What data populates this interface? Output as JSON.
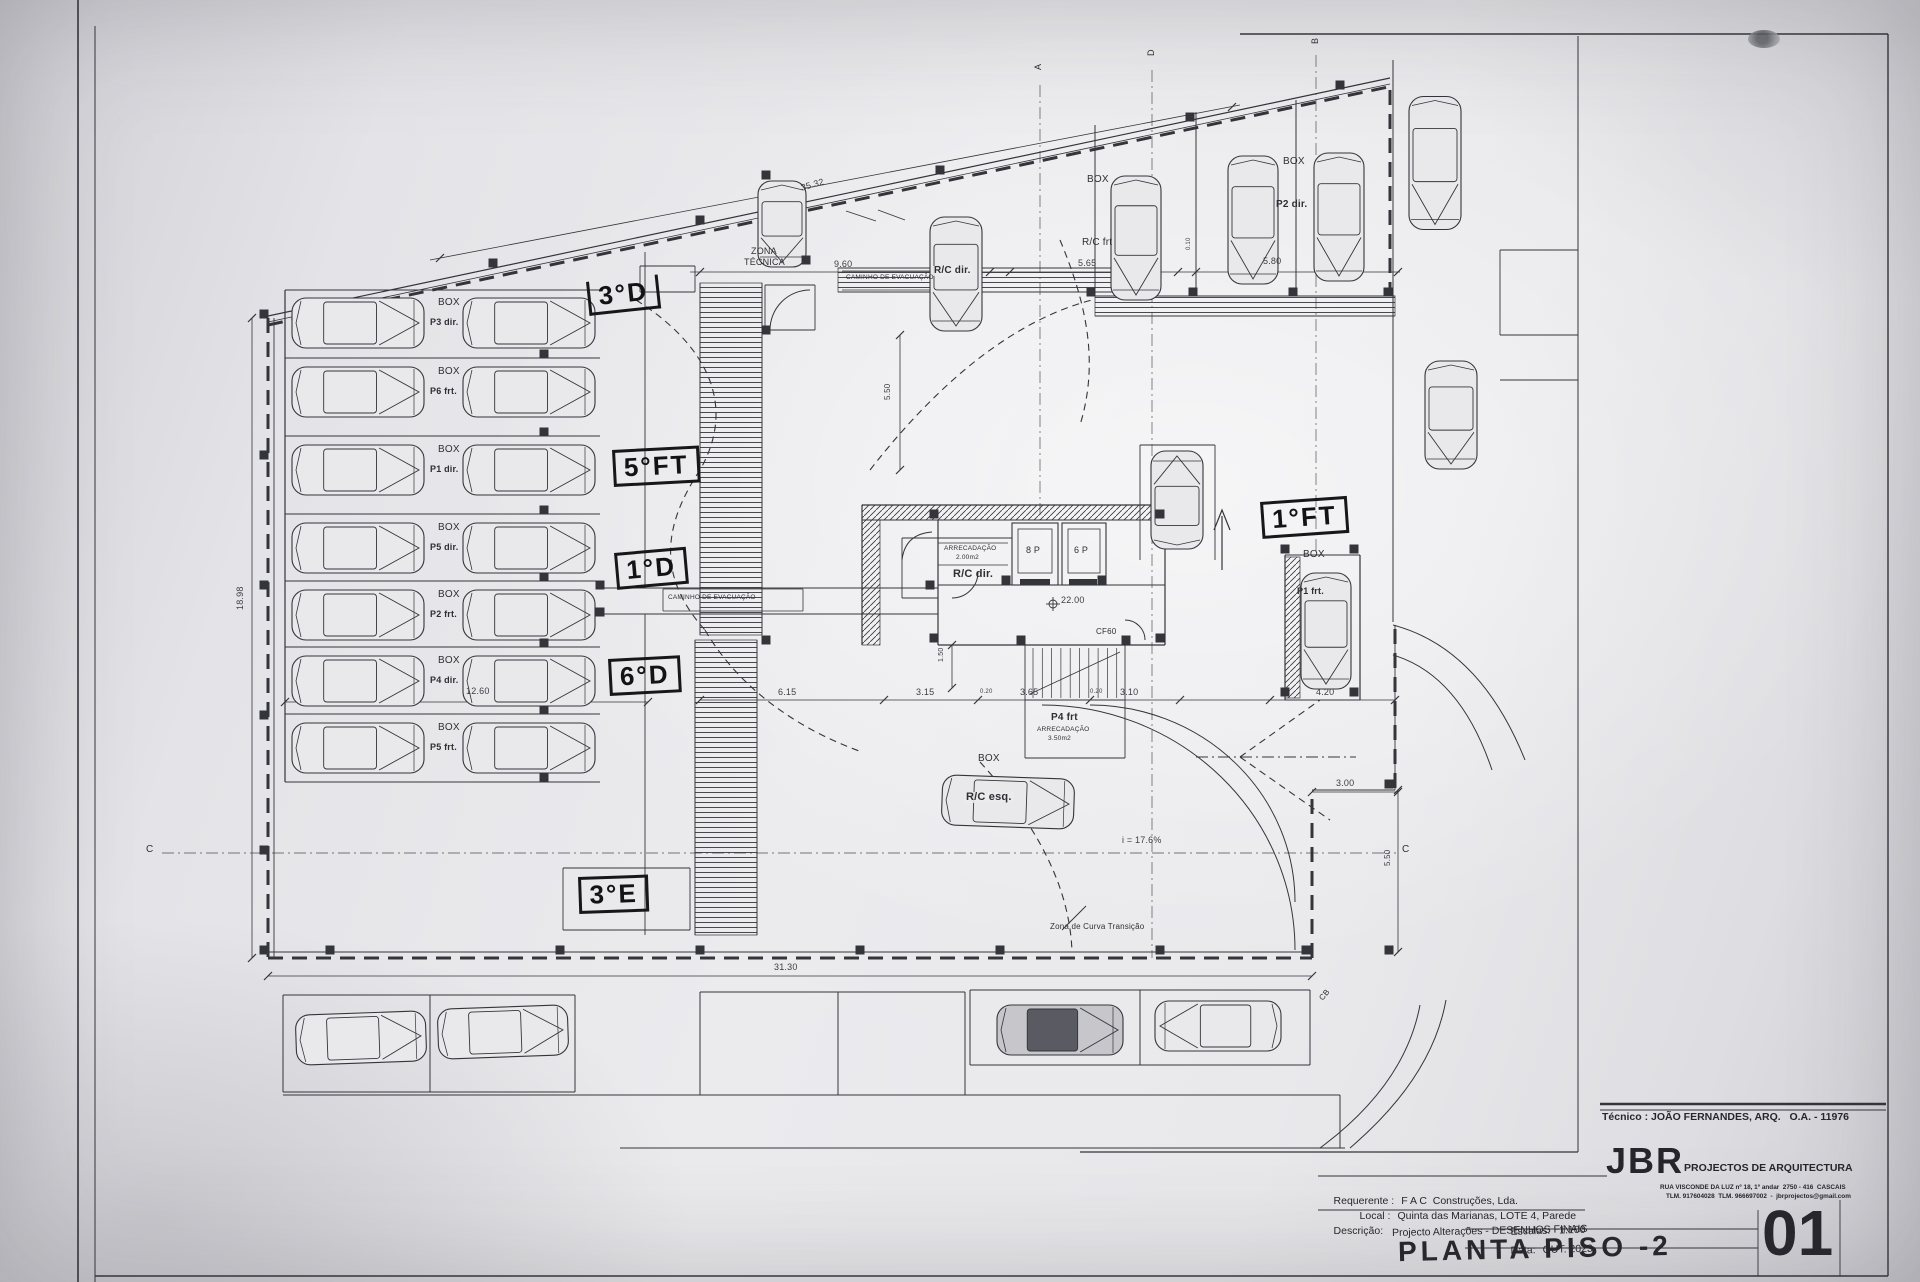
{
  "colors": {
    "paper": "#e9e9ec",
    "line": "#34343b",
    "hand": "#131316"
  },
  "title_block": {
    "tecnico_line": "Técnico : JOÃO FERNANDES, ARQ.   O.A. - 11976",
    "firm_initials": "JBR",
    "firm_name": "PROJECTOS DE ARQUITECTURA",
    "firm_address": "RUA VISCONDE DA LUZ nº 18, 1º andar  2750 - 416  CASCAIS",
    "firm_contact": "TLM. 917604028  TLM. 966697002  -  jbrprojectos@gmail.com",
    "requerente_label": "Requerente :",
    "requerente_value": "F A C  Construções, Lda.",
    "local_label": "Local :",
    "local_value": "Quinta das Marianas, LOTE 4, Parede",
    "descricao_label": "Descrição:",
    "descricao_value": "Projecto Alterações - DESENHOS FINAIS",
    "drawing_title": "PLANTA PISO -2",
    "escalas_label": "Escalas:",
    "escalas_value": "1:100",
    "data_label": "Data:",
    "data_value": "OUT. 2023",
    "sheet_number": "01"
  },
  "plan": {
    "labels": [
      {
        "n": "zona-tecnica-label",
        "t": "ZONA",
        "x": 751,
        "y": 247,
        "fs": 9
      },
      {
        "n": "zona-tecnica-label",
        "t": "TÉCNICA",
        "x": 744,
        "y": 258,
        "fs": 9
      },
      {
        "n": "dim-label",
        "t": "35.32",
        "x": 800,
        "y": 184,
        "fs": 9,
        "r": -16,
        "c": "dim"
      },
      {
        "n": "dim-label",
        "t": "9.60",
        "x": 834,
        "y": 260,
        "fs": 9,
        "c": "dim"
      },
      {
        "n": "car-label",
        "t": "R/C dir.",
        "x": 932,
        "y": 266,
        "fs": 10,
        "c": "carlbl"
      },
      {
        "n": "dim-label",
        "t": "5.65",
        "x": 1078,
        "y": 259,
        "fs": 9,
        "c": "dim"
      },
      {
        "n": "dim-label",
        "t": "0.10",
        "x": 1186,
        "y": 250,
        "fs": 6,
        "r": -90,
        "c": "dim"
      },
      {
        "n": "dim-label",
        "t": "5.80",
        "x": 1263,
        "y": 257,
        "fs": 9,
        "c": "dim"
      },
      {
        "n": "box-label",
        "t": "BOX",
        "x": 1087,
        "y": 175,
        "fs": 10
      },
      {
        "n": "car-label",
        "t": "R/C frt",
        "x": 1082,
        "y": 238,
        "fs": 10
      },
      {
        "n": "box-label",
        "t": "BOX",
        "x": 1283,
        "y": 157,
        "fs": 10
      },
      {
        "n": "car-label",
        "t": "P2 dir.",
        "x": 1276,
        "y": 200,
        "fs": 10,
        "c": "b"
      },
      {
        "n": "evacuation-path-label",
        "t": "CAMINHO DE EVACUAÇÃO",
        "x": 846,
        "y": 275,
        "fs": 6.5
      },
      {
        "n": "evacuation-path-label",
        "t": "CAMINHO DE EVACUAÇÃO",
        "x": 668,
        "y": 595,
        "fs": 6.5
      },
      {
        "n": "box-label",
        "t": "BOX",
        "x": 438,
        "y": 298,
        "fs": 10
      },
      {
        "n": "stall-label",
        "t": "P3 dir.",
        "x": 430,
        "y": 318,
        "fs": 9,
        "c": "b"
      },
      {
        "n": "box-label",
        "t": "BOX",
        "x": 438,
        "y": 367,
        "fs": 10
      },
      {
        "n": "stall-label",
        "t": "P6 frt.",
        "x": 430,
        "y": 387,
        "fs": 9,
        "c": "b"
      },
      {
        "n": "box-label",
        "t": "BOX",
        "x": 438,
        "y": 445,
        "fs": 10
      },
      {
        "n": "stall-label",
        "t": "P1 dir.",
        "x": 430,
        "y": 465,
        "fs": 9,
        "c": "b"
      },
      {
        "n": "box-label",
        "t": "BOX",
        "x": 438,
        "y": 523,
        "fs": 10
      },
      {
        "n": "stall-label",
        "t": "P5 dir.",
        "x": 430,
        "y": 543,
        "fs": 9,
        "c": "b"
      },
      {
        "n": "box-label",
        "t": "BOX",
        "x": 438,
        "y": 590,
        "fs": 10
      },
      {
        "n": "stall-label",
        "t": "P2 frt.",
        "x": 430,
        "y": 610,
        "fs": 9,
        "c": "b"
      },
      {
        "n": "box-label",
        "t": "BOX",
        "x": 438,
        "y": 656,
        "fs": 10
      },
      {
        "n": "stall-label",
        "t": "P4 dir.",
        "x": 430,
        "y": 676,
        "fs": 9,
        "c": "b"
      },
      {
        "n": "box-label",
        "t": "BOX",
        "x": 438,
        "y": 723,
        "fs": 10
      },
      {
        "n": "stall-label",
        "t": "P5 frt.",
        "x": 430,
        "y": 743,
        "fs": 9,
        "c": "b"
      },
      {
        "n": "room-label",
        "t": "ARRECADAÇÃO",
        "x": 944,
        "y": 546,
        "fs": 6.5
      },
      {
        "n": "room-label",
        "t": "2.00m2",
        "x": 956,
        "y": 555,
        "fs": 6.5
      },
      {
        "n": "room-label",
        "t": "R/C dir.",
        "x": 953,
        "y": 569,
        "fs": 11,
        "c": "b"
      },
      {
        "n": "lift-label",
        "t": "8 P",
        "x": 1026,
        "y": 546,
        "fs": 9
      },
      {
        "n": "lift-label",
        "t": "6 P",
        "x": 1074,
        "y": 546,
        "fs": 9
      },
      {
        "n": "level-label",
        "t": "22.00",
        "x": 1061,
        "y": 596,
        "fs": 9,
        "c": "dim"
      },
      {
        "n": "door-label",
        "t": "CF60",
        "x": 1096,
        "y": 628,
        "fs": 8
      },
      {
        "n": "stall-label",
        "t": "P4 frt",
        "x": 1051,
        "y": 713,
        "fs": 10,
        "c": "b"
      },
      {
        "n": "room-label",
        "t": "ARRECADAÇÃO",
        "x": 1037,
        "y": 727,
        "fs": 6.5
      },
      {
        "n": "room-label",
        "t": "3.50m2",
        "x": 1048,
        "y": 736,
        "fs": 6.5
      },
      {
        "n": "box-label",
        "t": "BOX",
        "x": 978,
        "y": 754,
        "fs": 10
      },
      {
        "n": "car-label",
        "t": "R/C esq.",
        "x": 964,
        "y": 792,
        "fs": 11,
        "c": "carlbl"
      },
      {
        "n": "box-label",
        "t": "BOX",
        "x": 1303,
        "y": 550,
        "fs": 10
      },
      {
        "n": "car-label",
        "t": "P1 frt.",
        "x": 1297,
        "y": 587,
        "fs": 9,
        "c": "b"
      },
      {
        "n": "slope-label",
        "t": "i = 17.6%",
        "x": 1122,
        "y": 836,
        "fs": 9,
        "c": "dim"
      },
      {
        "n": "curve-zone-label",
        "t": "Zona de Curva Transição",
        "x": 1050,
        "y": 923,
        "fs": 8
      },
      {
        "n": "dim-label",
        "t": "6.15",
        "x": 778,
        "y": 688,
        "fs": 9,
        "c": "dim"
      },
      {
        "n": "dim-label",
        "t": "3.15",
        "x": 916,
        "y": 688,
        "fs": 9,
        "c": "dim"
      },
      {
        "n": "dim-label",
        "t": "0.20",
        "x": 980,
        "y": 689,
        "fs": 6,
        "c": "dim"
      },
      {
        "n": "dim-label",
        "t": "3.65",
        "x": 1020,
        "y": 688,
        "fs": 9,
        "c": "dim"
      },
      {
        "n": "dim-label",
        "t": "0.20",
        "x": 1090,
        "y": 689,
        "fs": 6,
        "c": "dim"
      },
      {
        "n": "dim-label",
        "t": "3.10",
        "x": 1120,
        "y": 688,
        "fs": 9,
        "c": "dim"
      },
      {
        "n": "dim-label",
        "t": "4.20",
        "x": 1316,
        "y": 688,
        "fs": 9,
        "c": "dim"
      },
      {
        "n": "dim-label",
        "t": "12.60",
        "x": 466,
        "y": 687,
        "fs": 9,
        "c": "dim"
      },
      {
        "n": "dim-label",
        "t": "31.30",
        "x": 774,
        "y": 963,
        "fs": 9,
        "c": "dim"
      },
      {
        "n": "dim-label",
        "t": "18.98",
        "x": 236,
        "y": 610,
        "fs": 9,
        "r": -90,
        "c": "dim"
      },
      {
        "n": "dim-label",
        "t": "5.50",
        "x": 884,
        "y": 400,
        "fs": 8,
        "r": -90,
        "c": "dim"
      },
      {
        "n": "dim-label",
        "t": "5.50",
        "x": 1384,
        "y": 866,
        "fs": 8,
        "r": -90,
        "c": "dim"
      },
      {
        "n": "dim-label",
        "t": "3.00",
        "x": 1336,
        "y": 779,
        "fs": 9,
        "c": "dim"
      },
      {
        "n": "dim-label",
        "t": "1.50",
        "x": 938,
        "y": 662,
        "fs": 7,
        "r": -90,
        "c": "dim"
      },
      {
        "n": "section-marker",
        "t": "A",
        "x": 1034,
        "y": 70,
        "fs": 9,
        "r": -90
      },
      {
        "n": "section-marker",
        "t": "D",
        "x": 1147,
        "y": 56,
        "fs": 9,
        "r": -90
      },
      {
        "n": "section-marker",
        "t": "B",
        "x": 1311,
        "y": 44,
        "fs": 9,
        "r": -90
      },
      {
        "n": "section-marker",
        "t": "C",
        "x": 146,
        "y": 845,
        "fs": 10
      },
      {
        "n": "section-marker",
        "t": "C",
        "x": 1402,
        "y": 845,
        "fs": 10
      },
      {
        "n": "section-marker",
        "t": "CB",
        "x": 1318,
        "y": 997,
        "fs": 8,
        "r": -50
      },
      {
        "n": "handwritten-unit",
        "t": "3°D",
        "x": 586,
        "y": 282,
        "fs": 26,
        "r": -6,
        "c": "hand bars"
      },
      {
        "n": "handwritten-unit",
        "t": "5°FT",
        "x": 612,
        "y": 450,
        "fs": 26,
        "r": -3,
        "c": "hand box"
      },
      {
        "n": "handwritten-unit",
        "t": "1°D",
        "x": 614,
        "y": 553,
        "fs": 26,
        "r": -5,
        "c": "hand box"
      },
      {
        "n": "handwritten-unit",
        "t": "6°D",
        "x": 608,
        "y": 659,
        "fs": 26,
        "r": -3,
        "c": "hand box"
      },
      {
        "n": "handwritten-unit",
        "t": "3°E",
        "x": 578,
        "y": 877,
        "fs": 26,
        "r": -2,
        "c": "hand box"
      },
      {
        "n": "handwritten-unit",
        "t": "1°FT",
        "x": 1260,
        "y": 502,
        "fs": 26,
        "r": -4,
        "c": "hand box"
      }
    ]
  }
}
